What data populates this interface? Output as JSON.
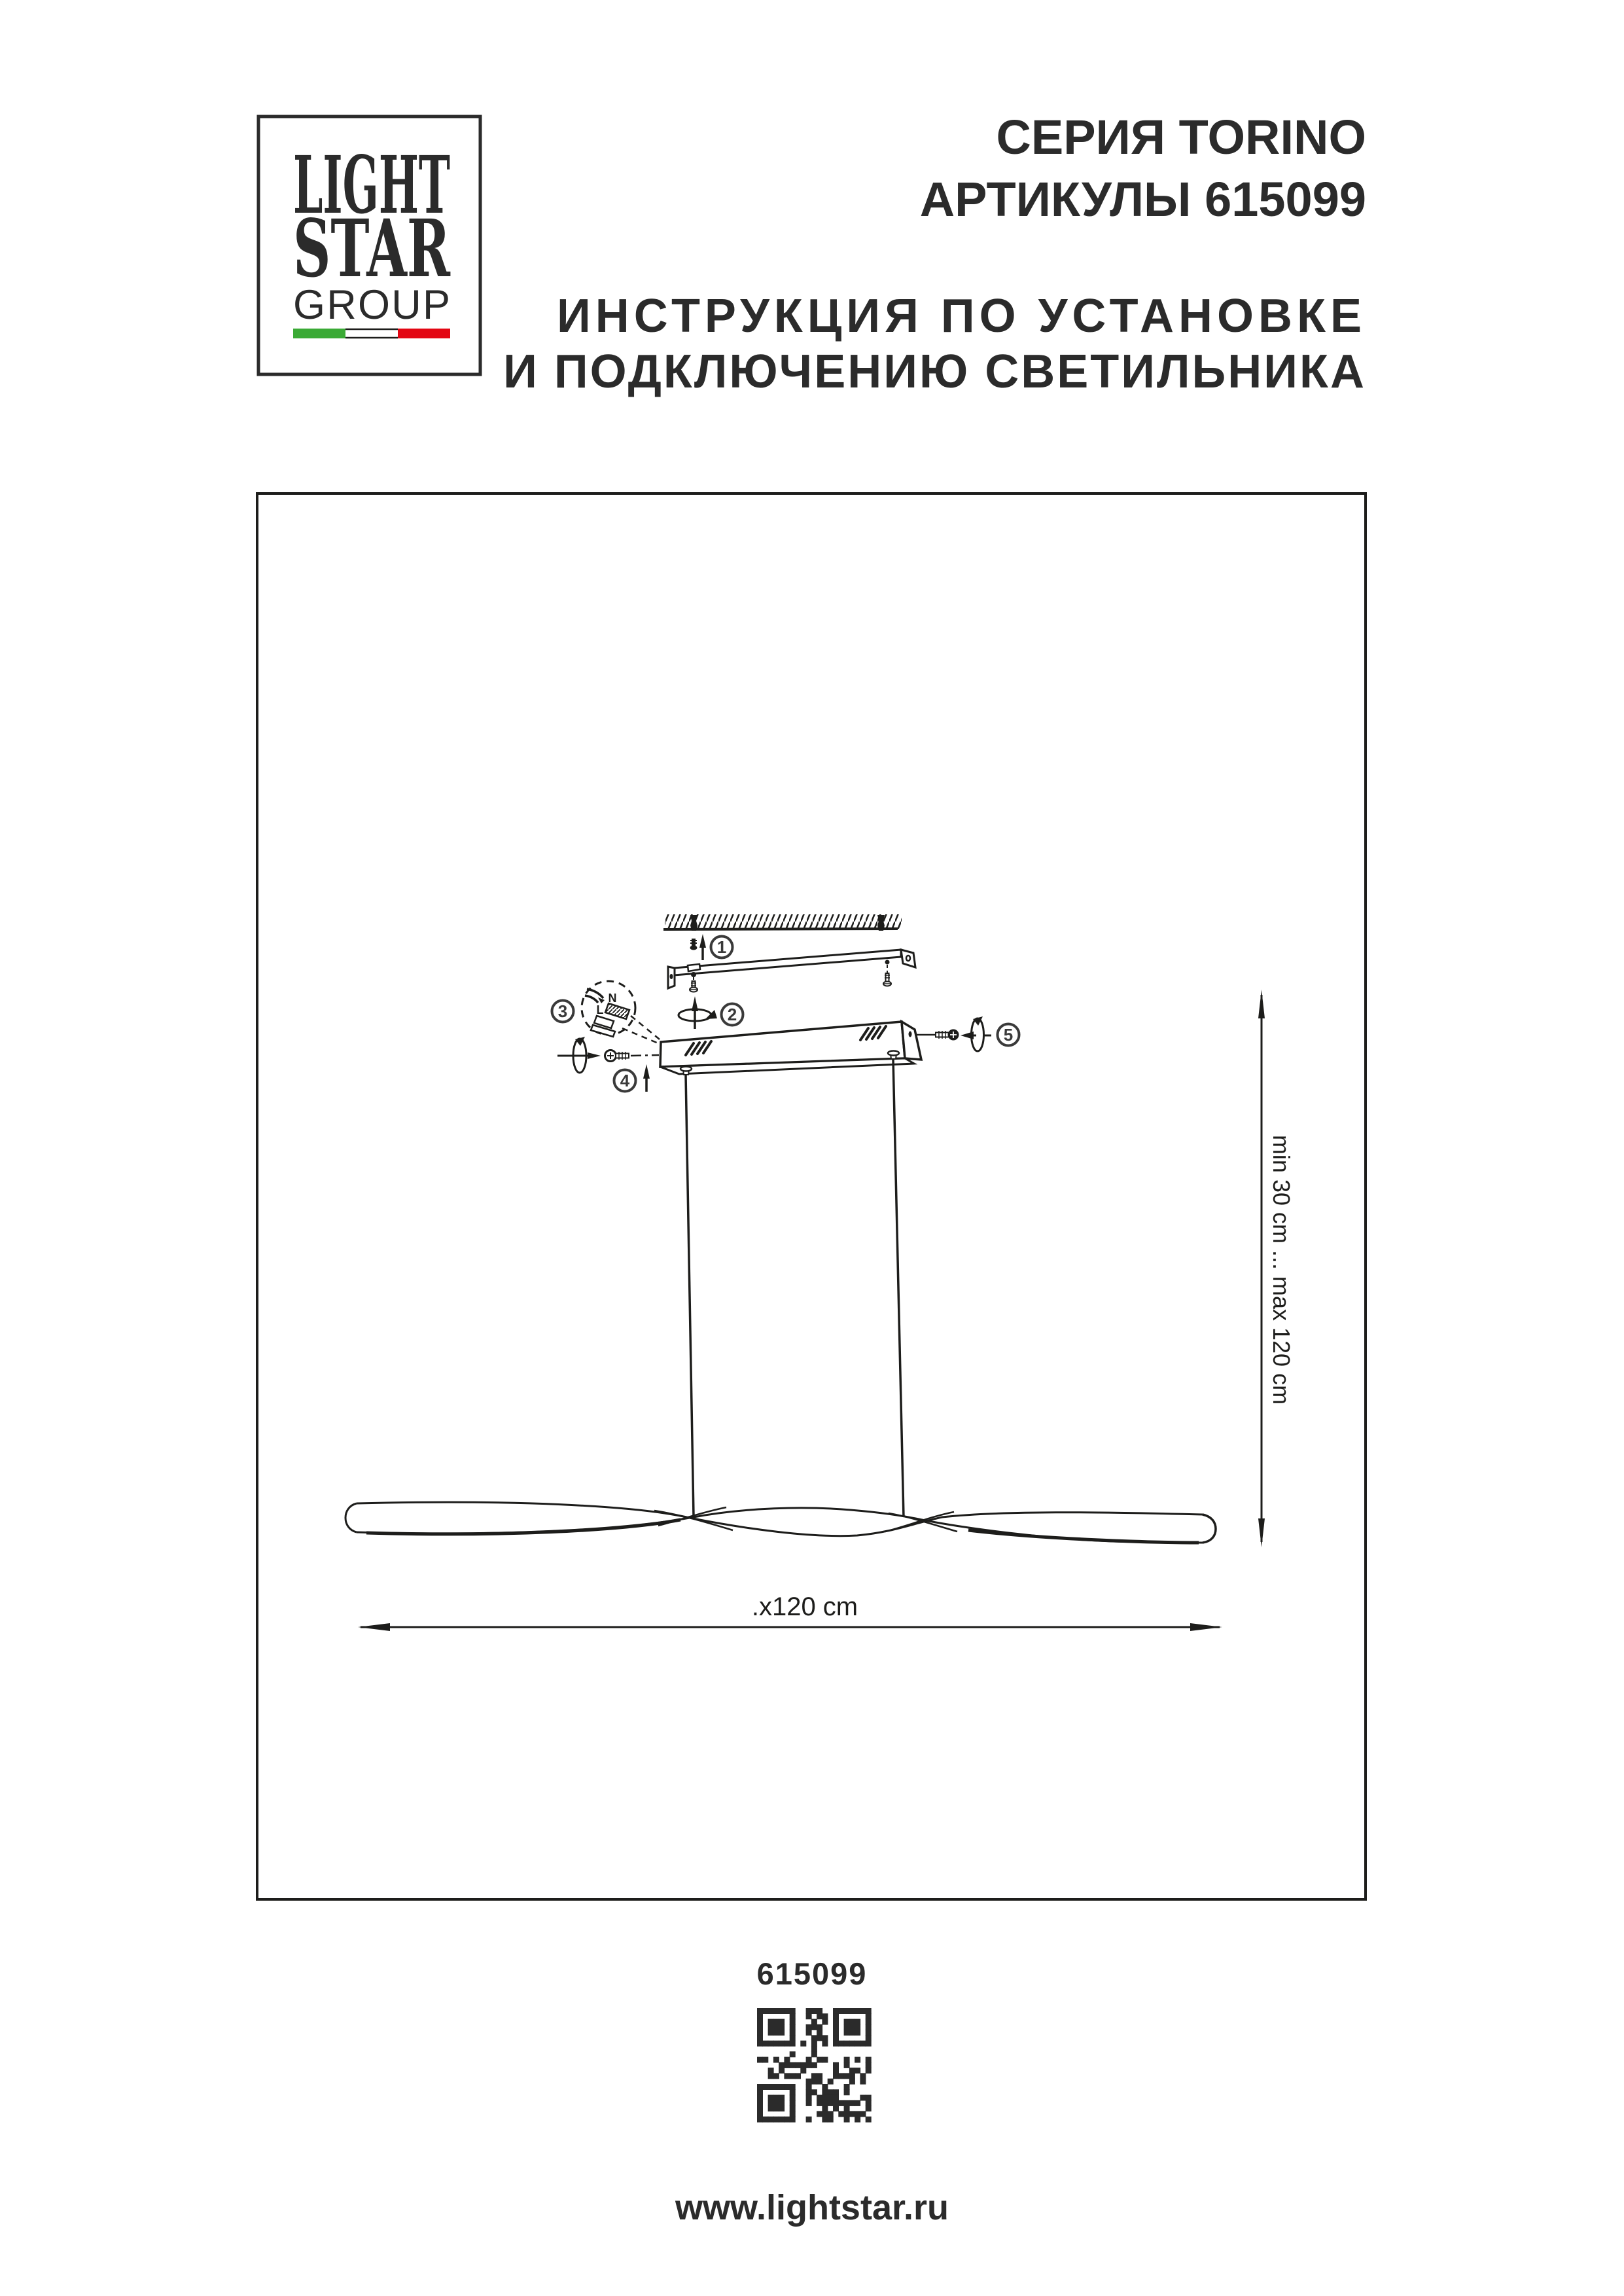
{
  "page": {
    "ink": "#1d1d1b"
  },
  "logo": {
    "light": "LIGHT",
    "star": "STAR",
    "group": "GROUP",
    "flag_green": "#3aaa35",
    "flag_white": "#ffffff",
    "flag_red": "#e30613"
  },
  "header": {
    "series": "СЕРИЯ TORINO",
    "articles": "АРТИКУЛЫ 615099",
    "title_line1": "ИНСТРУКЦИЯ ПО УСТАНОВКЕ",
    "title_line2": "И ПОДКЛЮЧЕНИЮ СВЕТИЛЬНИКА"
  },
  "diagram": {
    "callouts": [
      "1",
      "2",
      "3",
      "4",
      "5"
    ],
    "wire_n": "N",
    "wire_l": "L",
    "dim_vertical": "min 30 cm ... max 120 cm",
    "dim_horizontal": ".x120 cm"
  },
  "footer": {
    "article": "615099",
    "website": "www.lightstar.ru"
  }
}
